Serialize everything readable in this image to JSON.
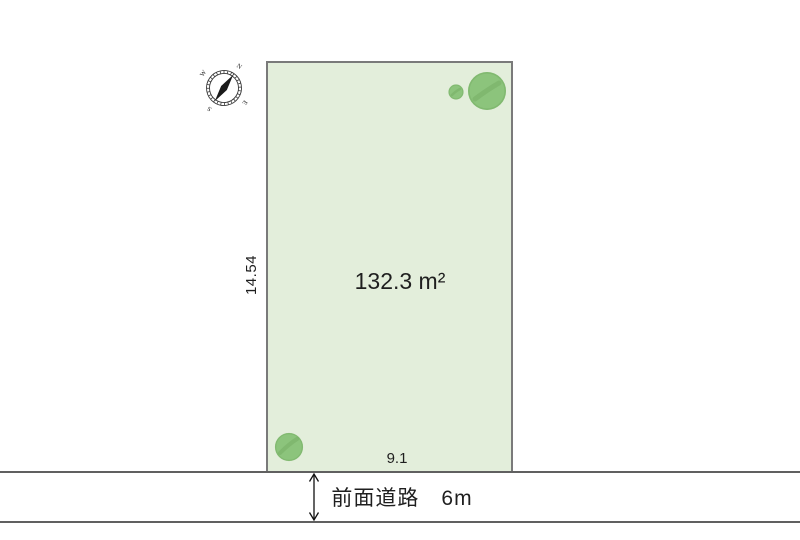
{
  "colors": {
    "plot_fill": "#e3eedb",
    "plot_border": "#7a7a7a",
    "road_line": "#606060",
    "tree_green": "#8cc47c",
    "tree_dark": "#73ac62",
    "text": "#1f1f1f"
  },
  "plot": {
    "area_label": "132.3 m²",
    "frontage_label": "9.1",
    "depth_label": "14.54"
  },
  "road": {
    "label": "前面道路　6m"
  },
  "compass": {
    "north": "N",
    "east": "E",
    "south": "S",
    "west": "W"
  }
}
